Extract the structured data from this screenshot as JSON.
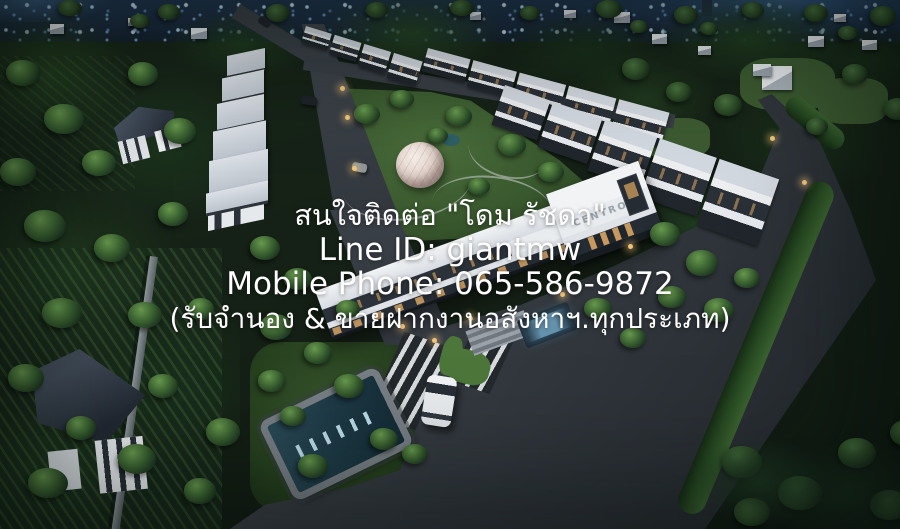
{
  "overlay": {
    "line1": "สนใจติดต่อ \"โดม รัชดา\"",
    "line2": "Line ID: giantmw",
    "line3": "Mobile Phone: 065-586-9872",
    "line4": "(รับจำนอง & ขายฝากงานอสังหาฯ.ทุกประเภท)"
  },
  "clubhouse": {
    "sign": "CENTRO"
  },
  "colors": {
    "overlay_text": "#ffffff",
    "asphalt": "#33393f",
    "roof": "#d3d9e0",
    "foliage": "#2c4a26",
    "window_light": "#d9a662",
    "city_light": "#9cc4e4",
    "pool_light": "#bfe1ee"
  }
}
